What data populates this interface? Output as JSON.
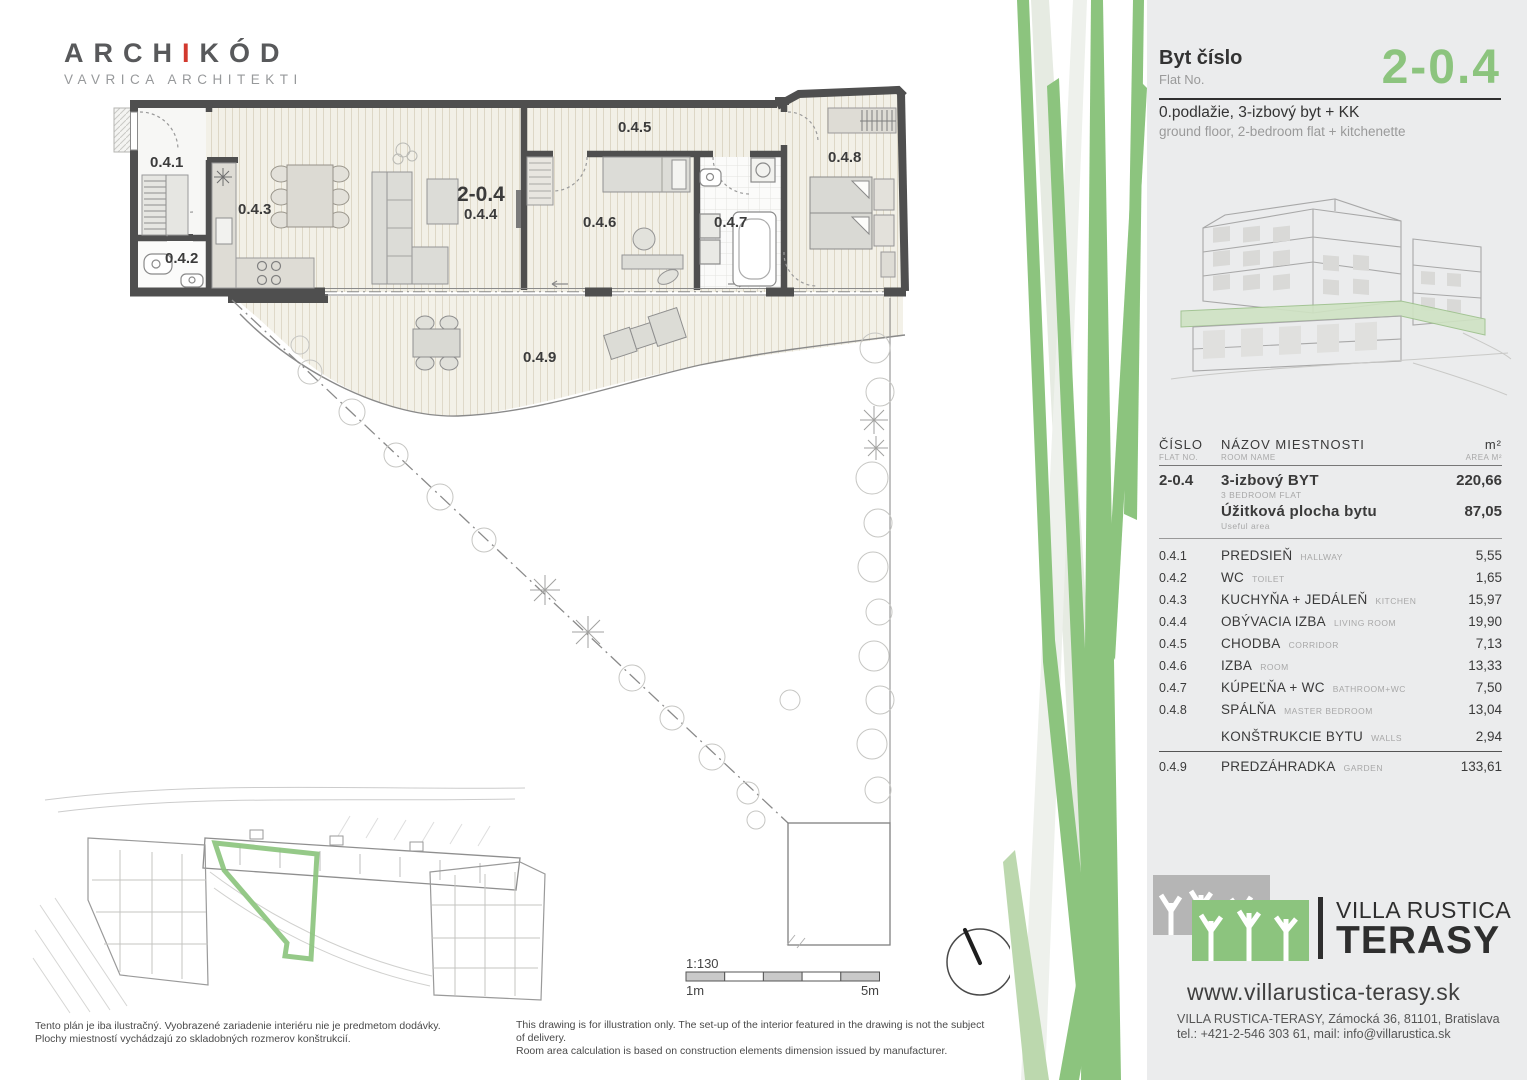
{
  "branding": {
    "architect_name_pre": "ARCH",
    "architect_name_i": "I",
    "architect_name_post": "KÓD",
    "architect_sub": "VAVRICA ARCHITEKTI"
  },
  "header": {
    "flat_label_sk": "Byt číslo",
    "flat_label_en": "Flat No.",
    "flat_number": "2-0.4",
    "floor_desc_sk": "0.podlažie, 3-izbový byt + KK",
    "floor_desc_en": "ground floor, 2-bedroom flat + kitchenette"
  },
  "plan": {
    "scale_ratio": "1:130",
    "scale_min": "1m",
    "scale_max": "5m"
  },
  "table": {
    "headers": {
      "col1_sk": "ČÍSLO",
      "col1_en": "FLAT NO.",
      "col2_sk": "NÁZOV  MIESTNOSTI",
      "col2_en": "ROOM NAME",
      "col3_sk": "m²",
      "col3_en": "AREA M²"
    },
    "flat_row": {
      "id": "2-0.4",
      "name_sk": "3-izbový BYT",
      "name_en": "3 BEDROOM FLAT",
      "area": "220,66",
      "useful_sk": "Úžitková plocha bytu",
      "useful_en": "Useful area",
      "useful_area": "87,05"
    },
    "rooms": [
      {
        "id": "0.4.1",
        "sk": "PREDSIEŇ",
        "en": "HALLWAY",
        "area": "5,55"
      },
      {
        "id": "0.4.2",
        "sk": "WC",
        "en": "TOILET",
        "area": "1,65"
      },
      {
        "id": "0.4.3",
        "sk": "KUCHYŇA + JEDÁLEŇ",
        "en": "KITCHEN",
        "area": "15,97"
      },
      {
        "id": "0.4.4",
        "sk": "OBÝVACIA IZBA",
        "en": "LIVING ROOM",
        "area": "19,90"
      },
      {
        "id": "0.4.5",
        "sk": "CHODBA",
        "en": "CORRIDOR",
        "area": "7,13"
      },
      {
        "id": "0.4.6",
        "sk": "IZBA",
        "en": "ROOM",
        "area": "13,33"
      },
      {
        "id": "0.4.7",
        "sk": "KÚPEĽŇA + WC",
        "en": "BATHROOM+WC",
        "area": "7,50"
      },
      {
        "id": "0.4.8",
        "sk": "SPÁLŇA",
        "en": "MASTER BEDROOM",
        "area": "13,04"
      }
    ],
    "walls_row": {
      "sk": "KONŠTRUKCIE BYTU",
      "en": "WALLS",
      "area": "2,94"
    },
    "garden_row": {
      "id": "0.4.9",
      "sk": "PREDZÁHRADKA",
      "en": "GARDEN",
      "area": "133,61"
    }
  },
  "company": {
    "logo_line1": "VILLA RUSTICA",
    "logo_line2": "TERASY",
    "website": "www.villarustica-terasy.sk",
    "address": "VILLA RUSTICA-TERASY, Zámocká 36, 81101, Bratislava",
    "contact": "tel.: +421-2-546 303 61, mail: info@villarustica.sk"
  },
  "footer": {
    "disclaimer_sk_1": "Tento plán je iba ilustračný. Vyobrazené zariadenie interiéru nie je predmetom dodávky.",
    "disclaimer_sk_2": "Plochy miestností vychádzajú zo skladobných rozmerov konštrukcií.",
    "disclaimer_en_1": "This drawing is for illustration only. The set-up of the interior featured in the drawing is not the subject of delivery.",
    "disclaimer_en_2": "Room area calculation is based on construction elements dimension issued by manufacturer."
  },
  "colors": {
    "accent_green": "#8cc47e",
    "logo_red": "#d2392e",
    "wall_gray": "#4f4f4f",
    "panel_bg": "#ebeced"
  }
}
